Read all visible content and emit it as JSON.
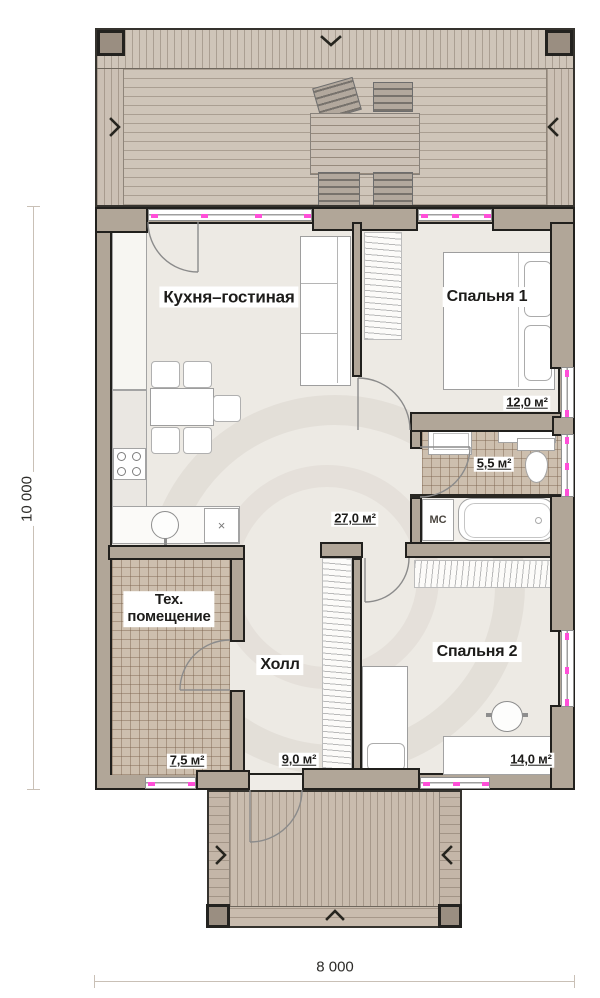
{
  "rooms": {
    "kitchen_living": {
      "name": "Кухня–гостиная",
      "area": "27,0 м²"
    },
    "bedroom1": {
      "name": "Спальня 1",
      "area": "12,0 м²"
    },
    "bathroom": {
      "area": "5,5 м²",
      "washer_label": "МС"
    },
    "tech_room": {
      "name": "Тех. помещение",
      "name_line1": "Тех.",
      "name_line2": "помещение",
      "area": "7,5 м²"
    },
    "hall": {
      "name": "Холл",
      "area": "9,0 м²"
    },
    "bedroom2": {
      "name": "Спальня 2",
      "area": "14,0 м²"
    }
  },
  "kitchen": {
    "appliance_marker": "×"
  },
  "dimensions": {
    "height_total": "10 000",
    "width_total": "8 000"
  },
  "colors": {
    "wall_fill": "#b1a698",
    "wall_outline": "#21201d",
    "floor": "#edeae4",
    "deck": "#cfc5b9",
    "tile_floor": "#cdbfae",
    "window_marker": "#ff4fd8"
  }
}
